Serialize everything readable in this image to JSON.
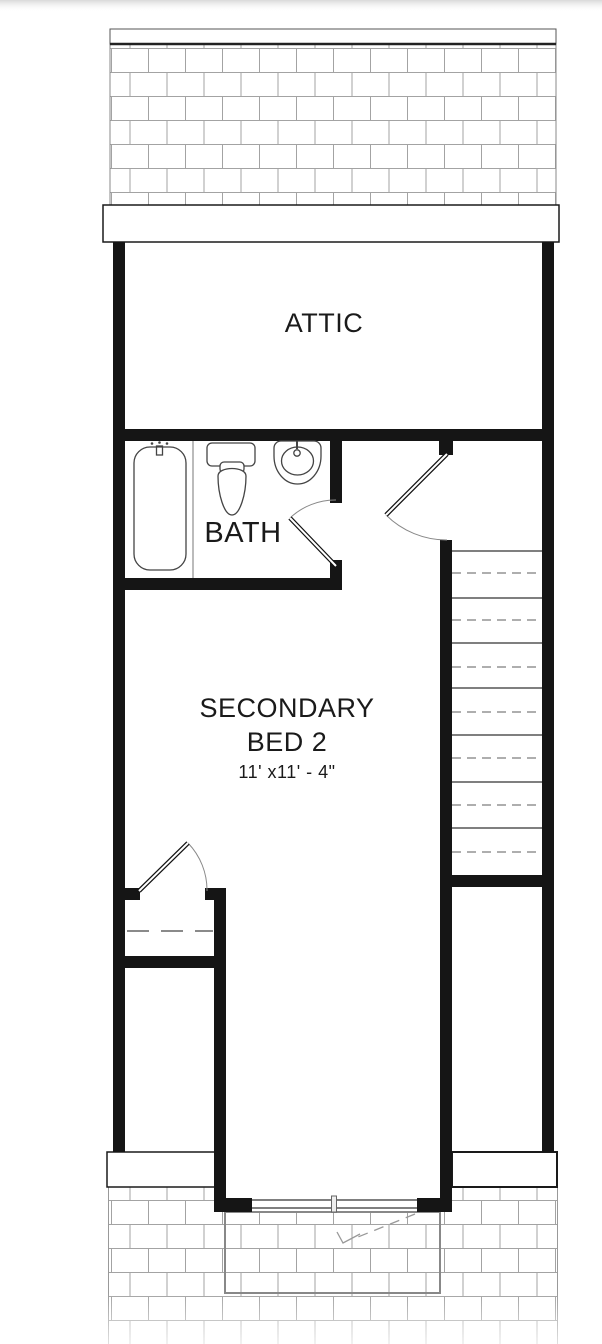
{
  "floor_plan": {
    "rooms": [
      {
        "name": "attic",
        "label": "ATTIC"
      },
      {
        "name": "bath",
        "label": "BATH"
      },
      {
        "name": "secondary-bed-2",
        "label_line_1": "SECONDARY",
        "label_line_2": "BED 2",
        "dimensions": "11' x11' - 4\""
      }
    ],
    "fixtures": [
      "bathtub-icon",
      "toilet-icon",
      "sink-icon",
      "stairs",
      "closet-rod",
      "door-swing",
      "sliding-door",
      "brick-paving"
    ],
    "colors": {
      "wall": "#151515",
      "fixture_line": "#444444",
      "brick_line": "#a3a3a3",
      "text": "#1a1a1a",
      "background": "#ffffff"
    }
  }
}
